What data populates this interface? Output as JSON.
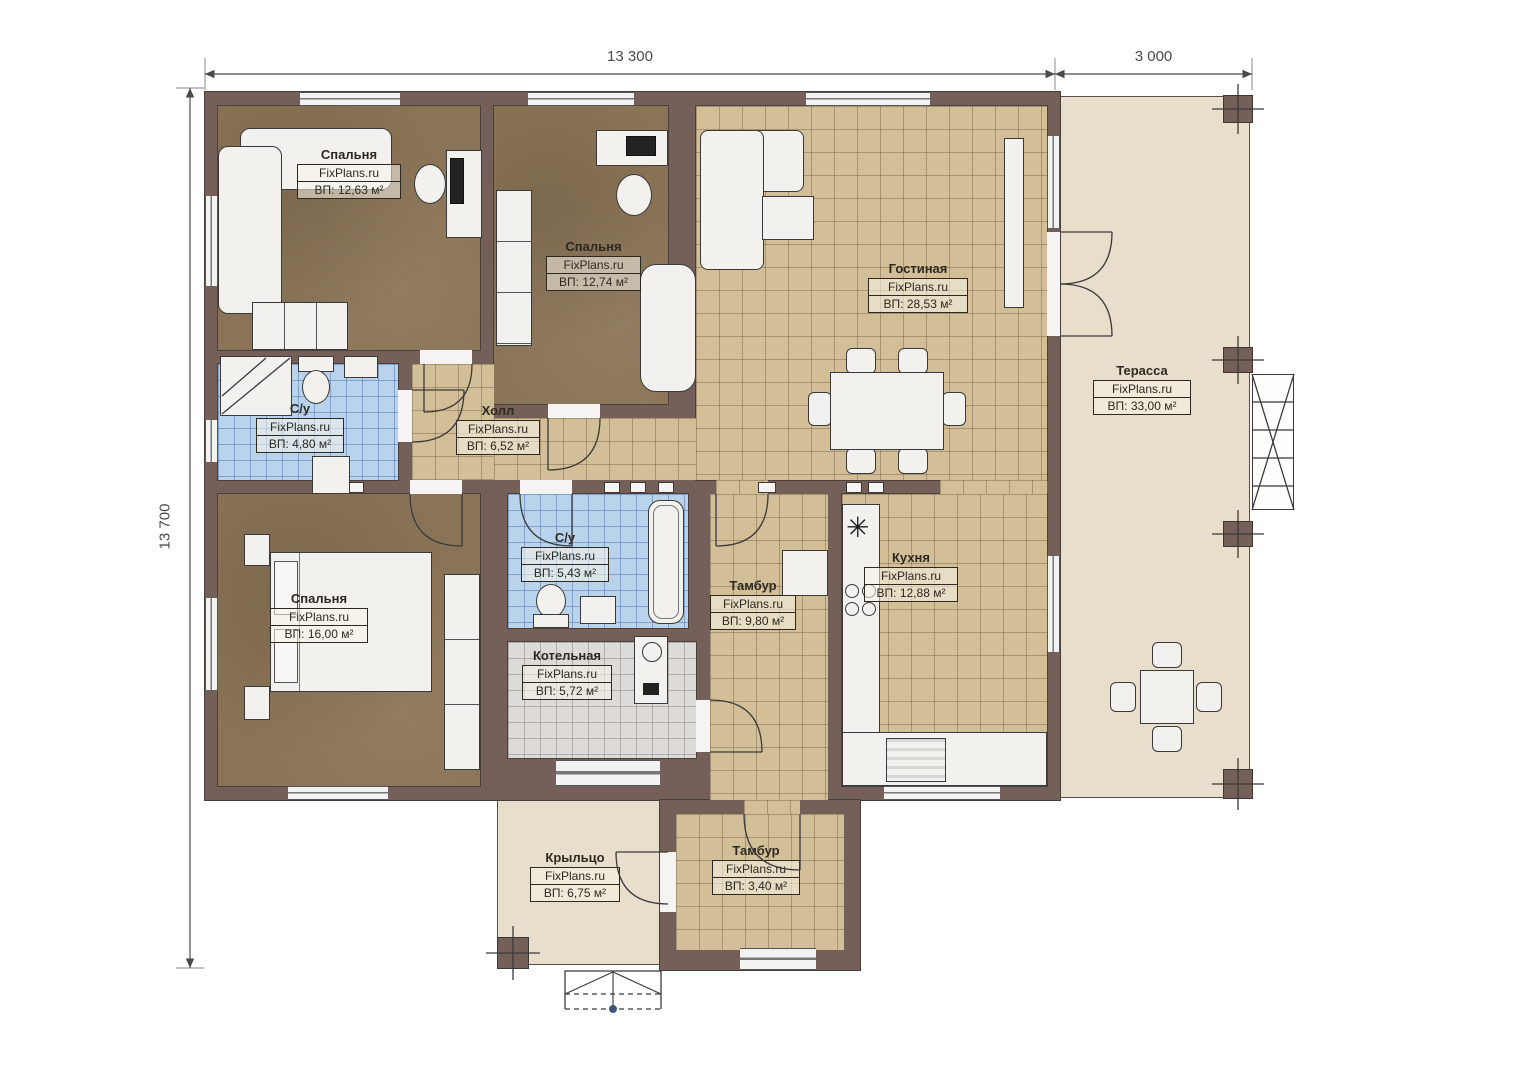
{
  "watermark": "FixPlans.ru",
  "dimensions": {
    "top_main": "13 300",
    "top_terrace": "3 000",
    "left": "13 700"
  },
  "rooms": [
    {
      "key": "bedroom-top-left",
      "name": "Спальня",
      "brand": "FixPlans.ru",
      "area": "ВП: 12,63 м²"
    },
    {
      "key": "bedroom-top-middle",
      "name": "Спальня",
      "brand": "FixPlans.ru",
      "area": "ВП: 12,74 м²"
    },
    {
      "key": "living-room",
      "name": "Гостиная",
      "brand": "FixPlans.ru",
      "area": "ВП: 28,53 м²"
    },
    {
      "key": "terrace",
      "name": "Терасса",
      "brand": "FixPlans.ru",
      "area": "ВП: 33,00 м²"
    },
    {
      "key": "bathroom-top",
      "name": "С/у",
      "brand": "FixPlans.ru",
      "area": "ВП: 4,80 м²"
    },
    {
      "key": "hall",
      "name": "Холл",
      "brand": "FixPlans.ru",
      "area": "ВП: 6,52 м²"
    },
    {
      "key": "bathroom-bottom",
      "name": "С/у",
      "brand": "FixPlans.ru",
      "area": "ВП: 5,43 м²"
    },
    {
      "key": "bedroom-bottom-left",
      "name": "Спальня",
      "brand": "FixPlans.ru",
      "area": "ВП: 16,00 м²"
    },
    {
      "key": "boiler-room",
      "name": "Котельная",
      "brand": "FixPlans.ru",
      "area": "ВП: 5,72 м²"
    },
    {
      "key": "vestibule-main",
      "name": "Тамбур",
      "brand": "FixPlans.ru",
      "area": "ВП: 9,80 м²"
    },
    {
      "key": "kitchen",
      "name": "Кухня",
      "brand": "FixPlans.ru",
      "area": "ВП: 12,88 м²"
    },
    {
      "key": "porch",
      "name": "Крыльцо",
      "brand": "FixPlans.ru",
      "area": "ВП: 6,75 м²"
    },
    {
      "key": "vestibule-back",
      "name": "Тамбур",
      "brand": "FixPlans.ru",
      "area": "ВП: 3,40 м²"
    }
  ],
  "colors": {
    "wall": "#746059",
    "floor_wood": "#8a7457",
    "floor_tile_tan": "#d3bf97",
    "floor_tile_blue": "#b9d3ec",
    "floor_tile_gray": "#dcdbd8",
    "terrace": "#e8decb",
    "furniture": "#f2f1ee"
  }
}
